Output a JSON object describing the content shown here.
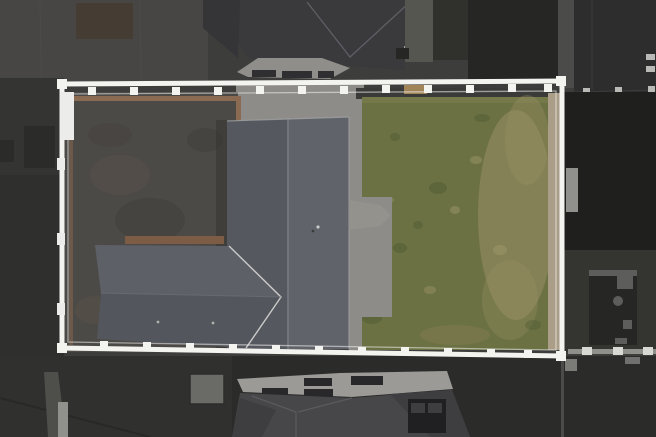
{
  "meta": {
    "title": "Aerial drone photograph of a property plot outlined with a white boundary",
    "view": "top-down",
    "content": "Rear garden plot with dark slate house roof, attached hip-roof garage, light concrete patio paths, dark paved driveway area and large worn lawn, all enclosed by a white highlighted boundary fence; neighbouring dark roofs, gardens and paving surround the plot"
  },
  "scene": {
    "elements": [
      "white-boundary-fence",
      "main-house-roof",
      "garage-roof",
      "porch-roof",
      "concrete-patio",
      "dark-driveway-patio",
      "lawn",
      "neighbor-roof-top",
      "neighbor-roof-bottom",
      "right-garden-shed",
      "bottom-shed",
      "bins",
      "tan-edging",
      "fence-posts"
    ]
  },
  "colors": {
    "pavement_base": "#3d3d3c",
    "pavement_topleft": "#474645",
    "topleft_patch": "#453c34",
    "left_band": "#343433",
    "left_band_dark": "#2f2f2e",
    "left_square": "#2b2b2a",
    "left_bar_mid": "#4e4e4b",
    "left_bar_light": "#90908c",
    "neighbor_roof": "#3a393b",
    "neighbor_roof_left": "#353436",
    "neighbor_bay": "#8f8e8b",
    "neighbor_windows": "#2f2f31",
    "neighbor_chimney": "#9c9b98",
    "pavement_strip_top": "#565651",
    "garden_small_top": "#30302c",
    "topright_garden": "#262625",
    "topright_path": "#4b4b49",
    "topright_roof": "#2d2d2e",
    "white_dash": "#b9b9b6",
    "right_garden": "#1f1f1e",
    "right_garden_low": "#343431",
    "right_shed": "#262625",
    "shed_detail_light": "#5d5d5b",
    "bottom_band": "#2b2b2a",
    "bottomleft_band": "#30302f",
    "bottom_roof_light": "#9b9a96",
    "bottom_roof_dark": "#47474a",
    "bottom_roof_darker": "#3e3e41",
    "bottom_panels": "#28282b",
    "bottom_shed": "#6a6a67",
    "bins": "#202023",
    "fence_right_line": "#8f8f8b",
    "fence_post_light": "#d8d8d4",
    "boundary_white": "#f3f3f0",
    "gate_post_white": "#ececea",
    "gate_patch": "#b7b7b2",
    "concrete": "#8e8c88",
    "patio_dark": "#4c4a47",
    "patio_mottle_dark": "#3f3d3a",
    "patio_mottle_brown": "#5c5349",
    "tan_edge": "#8a6a50",
    "tan_edge_garage": "#7c5c44",
    "tan_strip_right": "#ab9e88",
    "tan_box": "#a28459",
    "dark_strip_top": "#3a3a38",
    "lawn": "#6c7143",
    "lawn_worn": "#9a9168",
    "lawn_light": "#a89f74",
    "lawn_dark": "#4e5a33",
    "lawn_brown": "#8a8158",
    "lawn_top_light": "#7d8150",
    "roof_left": "#55585e",
    "roof_right": "#60636a",
    "garage_top": "#5d6067",
    "garage_bottom": "#53565c",
    "porch": "#94928c",
    "vent_light": "#c9c9c6",
    "vent_dark": "#3a3a38",
    "dot_light": "#b0b0ad",
    "roof_shadow": "#343432"
  }
}
